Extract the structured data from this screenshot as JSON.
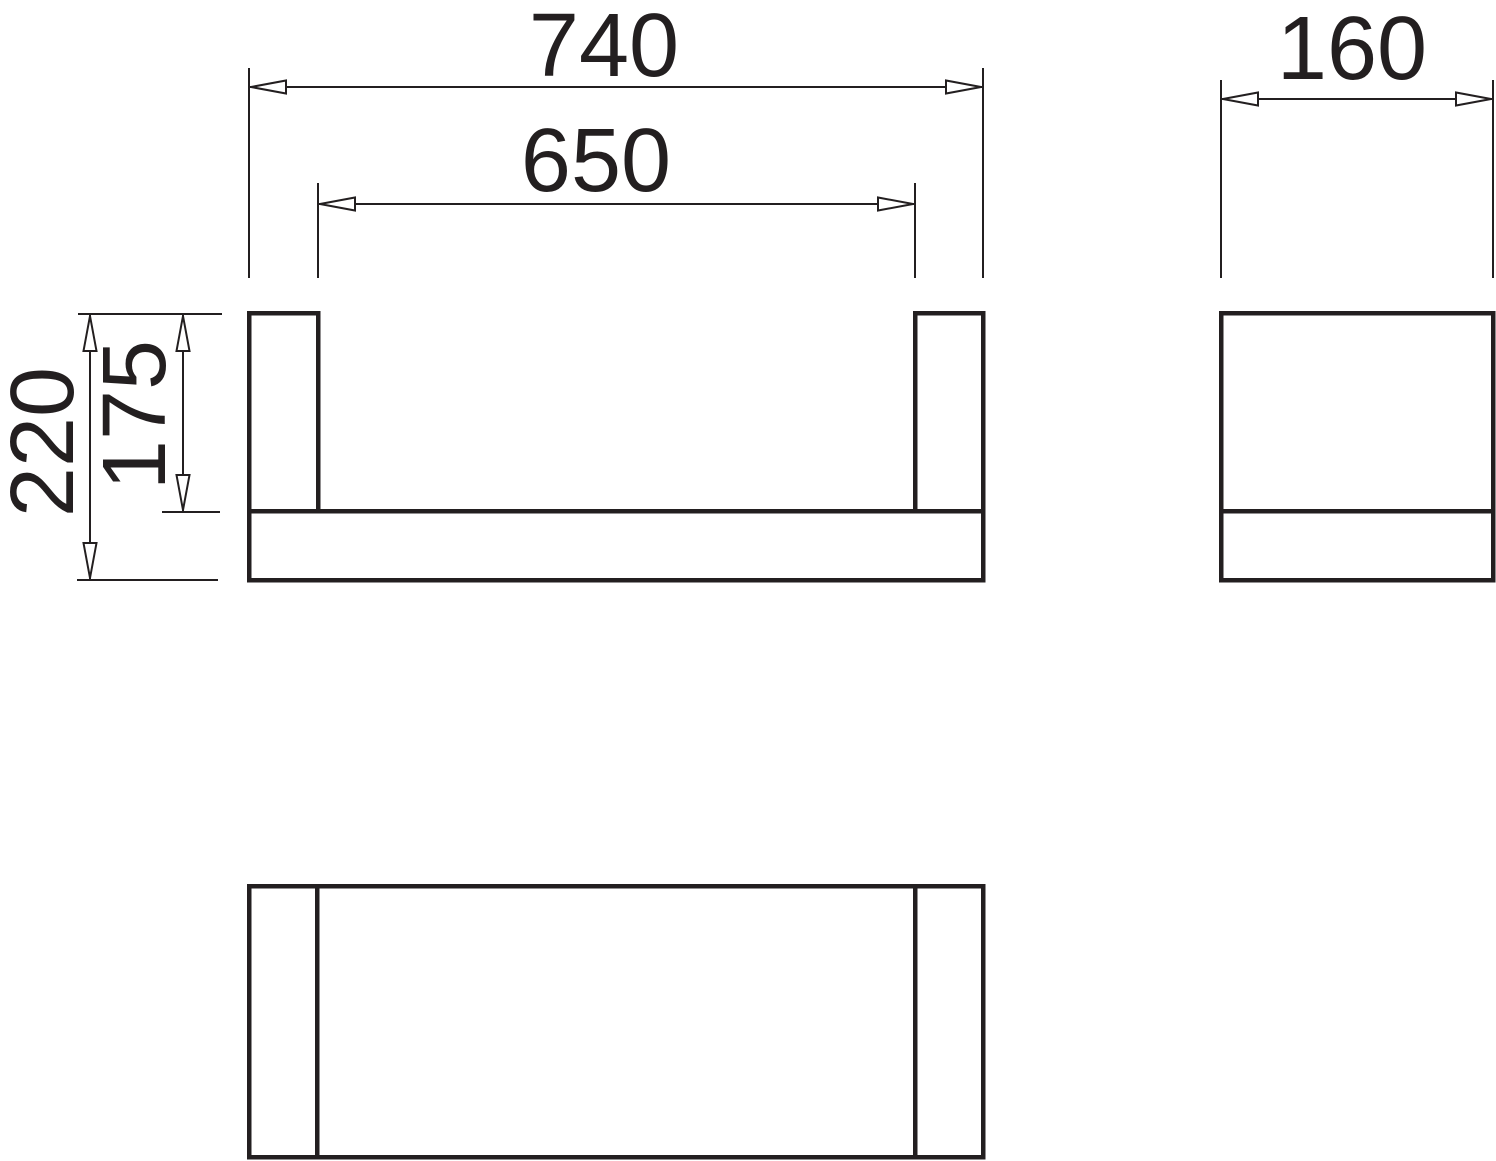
{
  "drawing": {
    "kind": "technical dimension drawing, three orthographic views of a U-shaped rail/shelf bracket",
    "dimensions": {
      "overall_width": "740",
      "inner_width": "650",
      "depth": "160",
      "overall_height": "220",
      "inner_height": "175"
    }
  },
  "colors": {
    "line": "#231f20",
    "background": "#ffffff"
  }
}
